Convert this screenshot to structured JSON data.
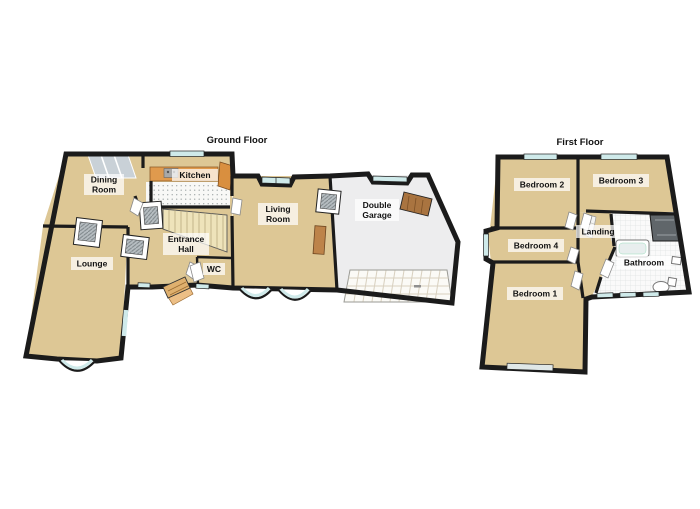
{
  "ground_floor": {
    "title": "Ground Floor",
    "rooms": {
      "dining_room": {
        "line1": "Dining",
        "line2": "Room"
      },
      "kitchen": {
        "line1": "Kitchen"
      },
      "entrance_hall": {
        "line1": "Entrance",
        "line2": "Hall"
      },
      "wc": {
        "line1": "WC"
      },
      "lounge": {
        "line1": "Lounge"
      },
      "living_room": {
        "line1": "Living",
        "line2": "Room"
      },
      "double_garage": {
        "line1": "Double",
        "line2": "Garage"
      }
    }
  },
  "first_floor": {
    "title": "First Floor",
    "rooms": {
      "bedroom2": {
        "line1": "Bedroom 2"
      },
      "bedroom3": {
        "line1": "Bedroom 3"
      },
      "bedroom4": {
        "line1": "Bedroom 4"
      },
      "landing": {
        "line1": "Landing"
      },
      "bathroom": {
        "line1": "Bathroom"
      },
      "bedroom1": {
        "line1": "Bedroom 1"
      }
    }
  },
  "colors": {
    "wall": "#1b1b1b",
    "floor_tan": "#ddc795",
    "kitchen_floor": "#f8f8f6",
    "garage_floor": "#ededee",
    "window_glass": "#cfeaea",
    "skylight_gray": "#c9d1d7",
    "counter_wood": "#e09a4d",
    "door_wood": "#a97440",
    "front_door_wood": "#dfb06e",
    "stairs_cream": "#eee3ba",
    "shower_gray": "#60666a"
  }
}
